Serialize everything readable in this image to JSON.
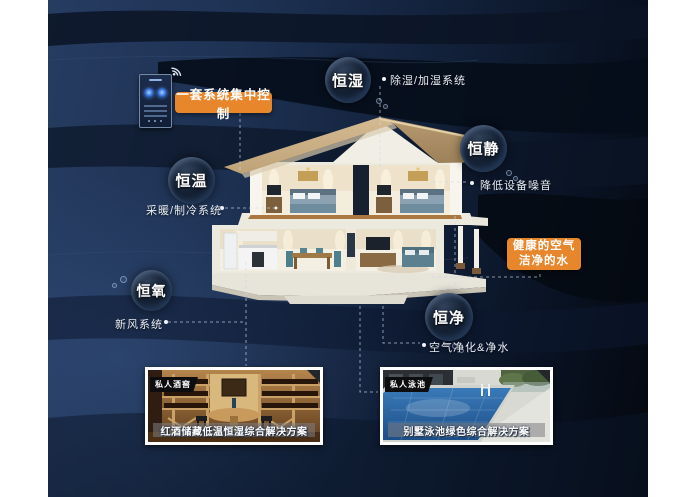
{
  "bubbles": [
    {
      "label": "恒湿"
    },
    {
      "label": "恒静"
    },
    {
      "label": "恒温"
    },
    {
      "label": "恒氧"
    },
    {
      "label": "恒净"
    }
  ],
  "callouts": {
    "dehumidify": "除湿/加湿系统",
    "noise": "降低设备噪音",
    "heating": "采暖/制冷系统",
    "fresh_air": "新风系统",
    "purification": "空气净化&净水"
  },
  "badges": {
    "central_control": "一套系统集中控制",
    "healthy_air": "健康的空气",
    "clean_water": "洁净的水"
  },
  "cards": [
    {
      "tag": "私人酒窖",
      "caption": "红酒储藏低温恒湿综合解决方案"
    },
    {
      "tag": "私人泳池",
      "caption": "别墅泳池绿色综合解决方案"
    }
  ],
  "icons": {
    "wifi": "wifi-icon"
  },
  "colors": {
    "accent_orange": "#E8862C",
    "background_navy": "#1E3254",
    "background_dark": "#04080F",
    "bubble_text": "#FFFFFF",
    "label_text": "#E9EEF6"
  }
}
